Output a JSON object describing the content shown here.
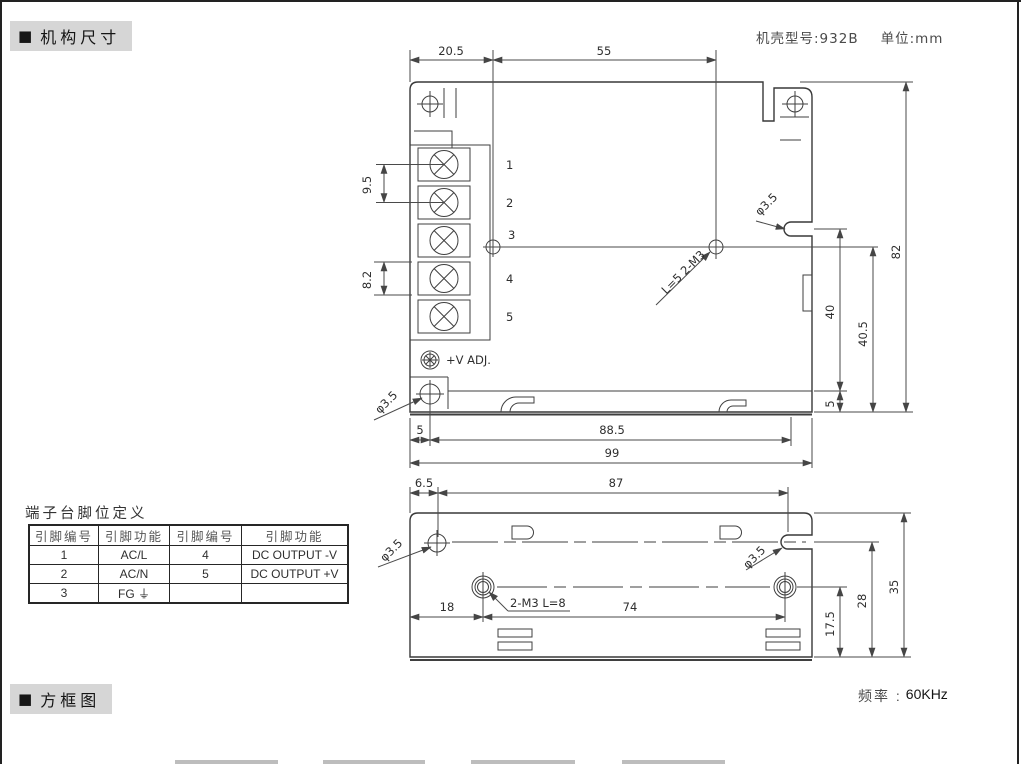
{
  "header": {
    "marker": "■",
    "section_mechanical": "机构尺寸",
    "model_label": "机壳型号:932B",
    "unit_label": "单位:mm"
  },
  "footer": {
    "marker": "■",
    "section_block_diagram": "方框图",
    "frequency_label": "频率 :",
    "frequency_value": "60KHz"
  },
  "pin_table": {
    "title": "端子台脚位定义",
    "headers": [
      "引脚编号",
      "引脚功能",
      "引脚编号",
      "引脚功能"
    ],
    "rows": [
      [
        "1",
        "AC/L",
        "4",
        "DC OUTPUT -V"
      ],
      [
        "2",
        "AC/N",
        "5",
        "DC OUTPUT +V"
      ],
      [
        "3",
        "FG ⏚",
        "",
        ""
      ]
    ]
  },
  "top_view": {
    "terminal_numbers": [
      "1",
      "2",
      "3",
      "4",
      "5"
    ],
    "adjust_label": "+V ADJ.",
    "dims": {
      "top_w1": "20.5",
      "top_w2": "55",
      "pitch_ac": "9.5",
      "pitch_dc": "8.2",
      "height_total": "82",
      "notch_height": "40",
      "hole_height": "40.5",
      "flange": "5",
      "hole_offset": "5",
      "hole_span": "88.5",
      "width_total": "99"
    },
    "labels": {
      "phi_side": "φ3.5",
      "phi_bottom": "φ3.5",
      "screw_spec": "L=5  2-M3"
    }
  },
  "bottom_view": {
    "dims": {
      "edge_to_hole": "6.5",
      "hole_span": "87",
      "screw_left": "18",
      "screw_span": "74",
      "screw_height": "17.5",
      "notch_height": "28",
      "height_total": "35"
    },
    "labels": {
      "phi_left": "φ3.5",
      "phi_right": "φ3.5",
      "screw_spec": "2-M3  L=8"
    }
  }
}
